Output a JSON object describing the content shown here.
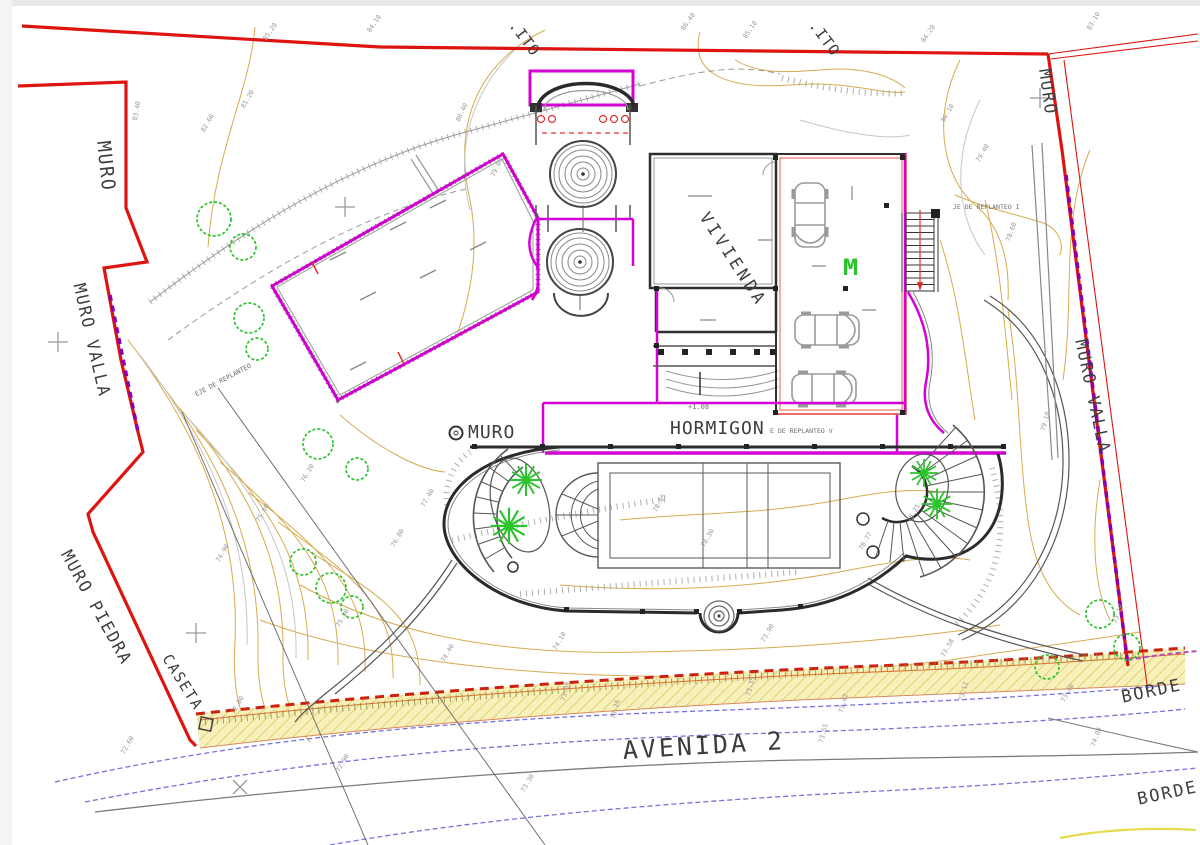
{
  "drawing": {
    "type": "architectural site plan",
    "street_label": "AVENIDA 2"
  },
  "labels": {
    "muro_top_left": {
      "text": "MURO"
    },
    "muro_valla_left": {
      "text": "MURO VALLA"
    },
    "muro_piedra": {
      "text": "MURO PIEDRA"
    },
    "caseta": {
      "text": "CASETA"
    },
    "muro_top_right": {
      "text": "MURO"
    },
    "muro_valla_right": {
      "text": "MURO VALLA"
    },
    "vivienda": {
      "text": "VIVIENDA"
    },
    "hormigon": {
      "text": "HORMIGON"
    },
    "muro_center": {
      "text": "MURO"
    },
    "avenida": {
      "text": "AVENIDA 2"
    },
    "borde_1": {
      "text": "BORDE"
    },
    "borde_2": {
      "text": "BORDE"
    },
    "ito_1": {
      "text": ".ITO"
    },
    "ito_2": {
      "text": ".ITO"
    },
    "replanteo_i": {
      "text": "JE DE REPLANTEO I"
    },
    "replanteo_v": {
      "text": "E DE REPLANTEO V"
    },
    "replanteo_left": {
      "text": "EJE DE REPLANTEO"
    },
    "plus_level": {
      "text": "+1.08"
    },
    "gate_m": {
      "text": "M"
    }
  },
  "colors": {
    "boundary_red": "#dd1410",
    "wall_magenta": "#d400d4",
    "valla_purple": "#8a00b0",
    "contour_tan": "#d2a23d",
    "tree_green": "#2bc42b",
    "road_blue": "#5b5bd6",
    "band_yellow": "#f7f0bb",
    "ink": "#2b2b2b"
  },
  "elevations": [
    {
      "t": "85.20",
      "x": 262,
      "y": 38,
      "r": -55
    },
    {
      "t": "84.10",
      "x": 366,
      "y": 30,
      "r": -55
    },
    {
      "t": "86.40",
      "x": 680,
      "y": 28,
      "r": -55
    },
    {
      "t": "85.10",
      "x": 742,
      "y": 36,
      "r": -55
    },
    {
      "t": "84.20",
      "x": 920,
      "y": 40,
      "r": -55
    },
    {
      "t": "83.10",
      "x": 1086,
      "y": 28,
      "r": -60
    },
    {
      "t": "82.60",
      "x": 200,
      "y": 130,
      "r": -60
    },
    {
      "t": "81.20",
      "x": 240,
      "y": 106,
      "r": -60
    },
    {
      "t": "80.40",
      "x": 455,
      "y": 120,
      "r": -65
    },
    {
      "t": "79.80",
      "x": 490,
      "y": 175,
      "r": -65
    },
    {
      "t": "80.10",
      "x": 940,
      "y": 120,
      "r": -60
    },
    {
      "t": "79.40",
      "x": 975,
      "y": 160,
      "r": -60
    },
    {
      "t": "78.60",
      "x": 1005,
      "y": 240,
      "r": -70
    },
    {
      "t": "78.05",
      "x": 652,
      "y": 510,
      "r": -60
    },
    {
      "t": "78.30",
      "x": 700,
      "y": 545,
      "r": -60
    },
    {
      "t": "78.77",
      "x": 858,
      "y": 548,
      "r": -60
    },
    {
      "t": "78.21",
      "x": 906,
      "y": 520,
      "r": -60
    },
    {
      "t": "77.40",
      "x": 420,
      "y": 505,
      "r": -60
    },
    {
      "t": "76.80",
      "x": 390,
      "y": 545,
      "r": -60
    },
    {
      "t": "76.20",
      "x": 300,
      "y": 480,
      "r": -60
    },
    {
      "t": "75.60",
      "x": 255,
      "y": 520,
      "r": -60
    },
    {
      "t": "74.90",
      "x": 215,
      "y": 560,
      "r": -60
    },
    {
      "t": "75.30",
      "x": 335,
      "y": 625,
      "r": -60
    },
    {
      "t": "74.40",
      "x": 440,
      "y": 660,
      "r": -60
    },
    {
      "t": "74.10",
      "x": 552,
      "y": 648,
      "r": -60
    },
    {
      "t": "73.90",
      "x": 760,
      "y": 640,
      "r": -60
    },
    {
      "t": "73.58",
      "x": 940,
      "y": 655,
      "r": -60
    },
    {
      "t": "73.40",
      "x": 1060,
      "y": 700,
      "r": -60
    },
    {
      "t": "73.08",
      "x": 560,
      "y": 700,
      "r": -75
    },
    {
      "t": "73.26",
      "x": 610,
      "y": 718,
      "r": -75
    },
    {
      "t": "73.35",
      "x": 745,
      "y": 695,
      "r": -75
    },
    {
      "t": "73.42",
      "x": 838,
      "y": 712,
      "r": -75
    },
    {
      "t": "73.12",
      "x": 958,
      "y": 700,
      "r": -75
    },
    {
      "t": "72.80",
      "x": 230,
      "y": 712,
      "r": -60
    },
    {
      "t": "72.60",
      "x": 120,
      "y": 752,
      "r": -60
    },
    {
      "t": "73.18",
      "x": 1112,
      "y": 622,
      "r": -70
    },
    {
      "t": "74.08",
      "x": 1090,
      "y": 745,
      "r": -70
    },
    {
      "t": "73.55",
      "x": 818,
      "y": 742,
      "r": -75
    },
    {
      "t": "72.90",
      "x": 335,
      "y": 770,
      "r": -60
    },
    {
      "t": "73.30",
      "x": 520,
      "y": 790,
      "r": -60
    },
    {
      "t": "83.40",
      "x": 132,
      "y": 120,
      "r": -80
    },
    {
      "t": "79.10",
      "x": 1040,
      "y": 430,
      "r": -75
    }
  ]
}
